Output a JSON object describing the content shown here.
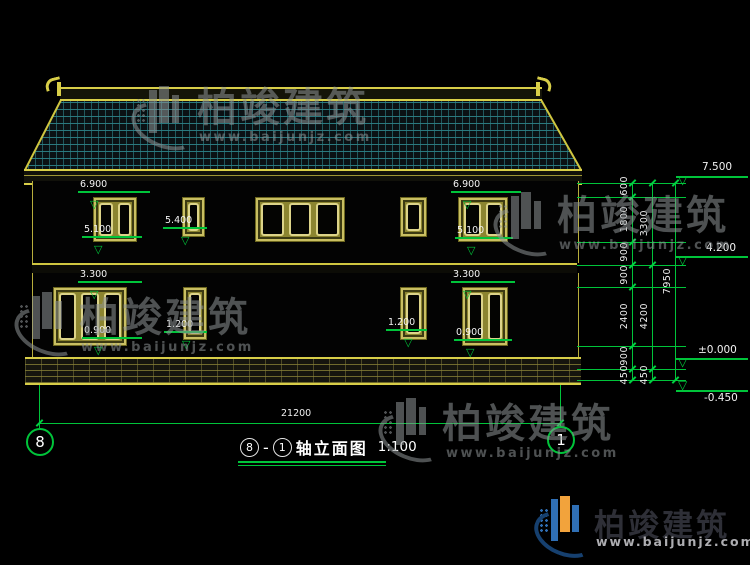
{
  "watermark": {
    "brand": "柏竣建筑",
    "url": "www.baijunjz.com"
  },
  "logo": {
    "brand": "柏竣建筑",
    "url": "www.baijunjz.com"
  },
  "icons": {
    "level_triangle": "▽"
  },
  "title": {
    "axis_left": "8",
    "separator": "-",
    "axis_right": "1",
    "text": "轴立面图",
    "scale": "1:100"
  },
  "bottom": {
    "total_width": "21200",
    "axis_left": "8",
    "axis_right": "1"
  },
  "window_marks": {
    "f2_left_top": "6.900",
    "f2_left_sill": "5.100",
    "f2_small_sill": "5.400",
    "f2_right_top": "6.900",
    "f2_right_sill": "5.100",
    "f1_left_top": "3.300",
    "f1_left_sill": "0.900",
    "f1_small_left_sill": "1.200",
    "f1_small_right_sill": "1.200",
    "f1_right_top": "3.300",
    "f1_right_sill": "0.900"
  },
  "right_dims": {
    "seg600": "600",
    "seg1800": "1800",
    "seg900a": "900",
    "seg900b": "900",
    "seg2400": "2400",
    "seg900c": "900",
    "seg450a": "450",
    "seg3300": "3300",
    "seg4200": "4200",
    "seg450b": "450",
    "total": "7950"
  },
  "levels": {
    "roof": "7.500",
    "floor2": "4.200",
    "zero": "±0.000",
    "base": "-0.450"
  },
  "colors": {
    "dim_green": "#00c43a",
    "outline_yellow": "#d8ce48",
    "roof_teal": "#2c7e84"
  }
}
